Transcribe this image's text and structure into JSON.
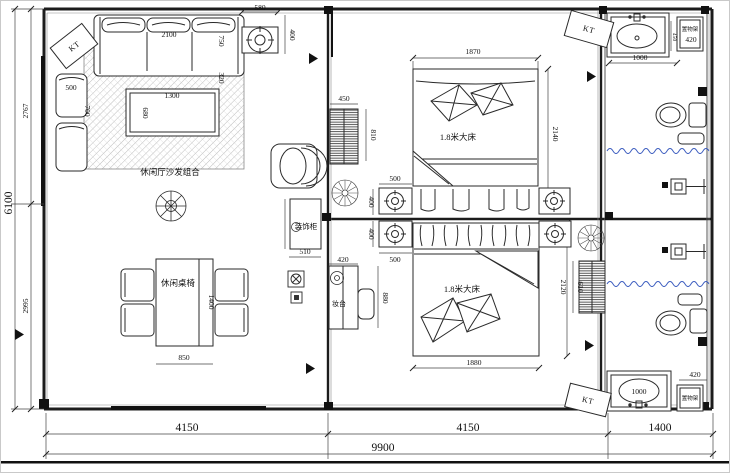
{
  "drawing": {
    "kind": "residential floor plan"
  },
  "colors": {
    "line": "#1c1c1c",
    "dim_line": "#444444",
    "shower_curtain": "#3f5fc0",
    "hatch": "#999999"
  },
  "labels": {
    "sofa_area": "休闲厅沙发组合",
    "dining_set": "休闲桌椅",
    "deco_cabinet": "装饰柜",
    "dresser": "妆台",
    "bed": "1.8米大床",
    "rack": "置物架",
    "ac_unit": "KT"
  },
  "dims": {
    "overall_width": "9900",
    "span_living": "4150",
    "span_bedrooms": "4150",
    "span_bath": "1400",
    "overall_height": "6100",
    "height_upper": "2767",
    "height_lower": "2995",
    "sofa_width": "2100",
    "sofa_depth": "750",
    "sofa_rug_gap": "320",
    "ceiling_lamp_width": "580",
    "ceiling_lamp_height": "400",
    "armchair_width": "500",
    "armchair_depth": "700",
    "coffee_table_length": "1300",
    "coffee_table_width": "680",
    "dining_table_length": "1400",
    "dining_table_width": "850",
    "shoe_cabinet_width": "450",
    "shoe_cabinet_height": "810",
    "deco_cabinet_width": "510",
    "dresser_width": "420",
    "dresser_height": "880",
    "nightstand_width": "500",
    "nightstand_depth": "400",
    "bed1_width": "1870",
    "bed1_length": "2140",
    "bed2_width": "1880",
    "bed2_length": "2120",
    "wardrobe_height": "610",
    "vanity_width": "1000",
    "rack_width": "420",
    "rack_depth": "450"
  }
}
